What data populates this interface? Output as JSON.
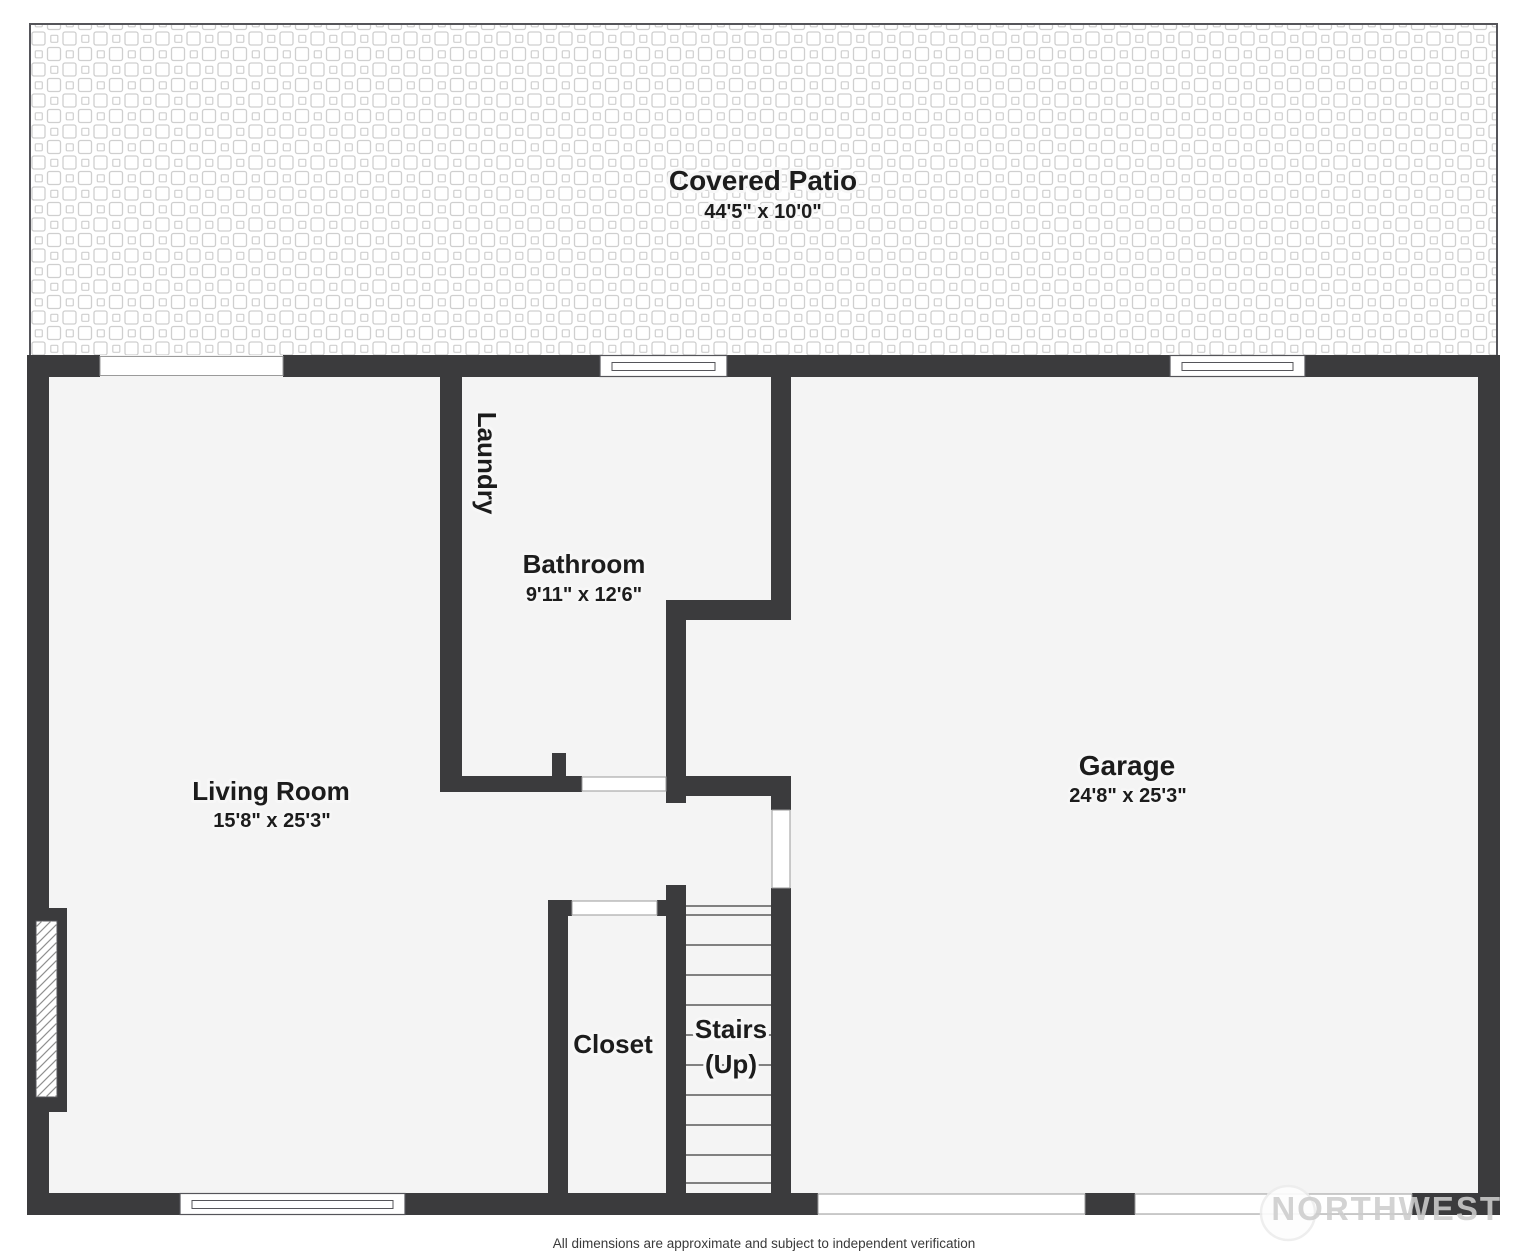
{
  "colors": {
    "wall": "#3b3b3d",
    "floor": "#f4f4f4",
    "tile_line": "#cfcfcf",
    "text": "#1c1c1c"
  },
  "rooms": {
    "covered_patio": {
      "name": "Covered Patio",
      "dims": "44'5\" x 10'0\""
    },
    "laundry": {
      "name": "Laundry"
    },
    "bathroom": {
      "name": "Bathroom",
      "dims": "9'11\" x 12'6\""
    },
    "living_room": {
      "name": "Living Room",
      "dims": "15'8\" x 25'3\""
    },
    "garage": {
      "name": "Garage",
      "dims": "24'8\" x 25'3\""
    },
    "closet": {
      "name": "Closet"
    },
    "stairs": {
      "name": "Stairs",
      "sub": "(Up)"
    }
  },
  "footer": {
    "disclaimer": "All dimensions are approximate and subject to independent verification"
  },
  "watermark": {
    "text": "NORTHWEST"
  }
}
